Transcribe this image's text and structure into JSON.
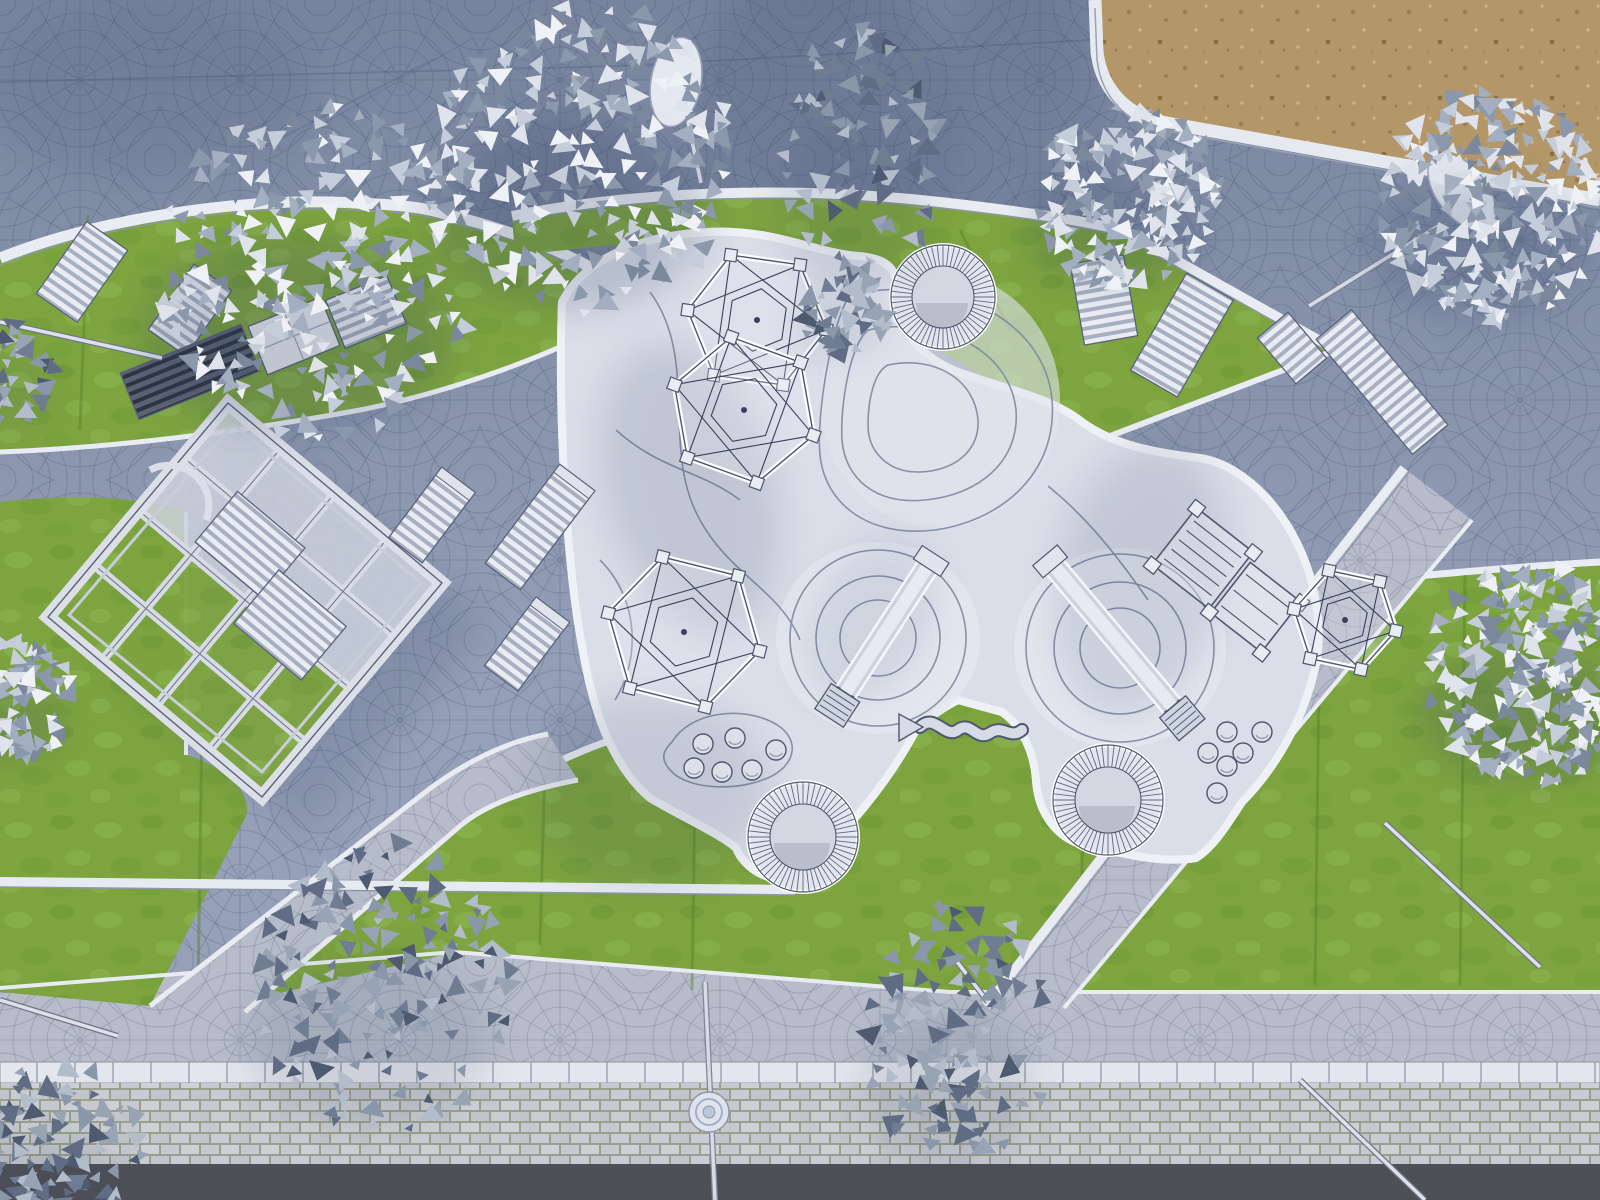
{
  "scene": {
    "kind": "aerial-architectural-render",
    "subject": "top-down clay-style 3D rendering of a public playground plaza with fan-pattern cobblestone paving, organic white play surface, lawns, pergola, play equipment, benches and desaturated trees",
    "camera": "orthographic top-down (drone view)",
    "has_text": false
  },
  "palette": {
    "plaza": "#96a0b8",
    "plazaLine": "#43536f",
    "pathLight": "#b6bcc9",
    "pathLine": "#6b7893",
    "grass": "#7da43f",
    "grassLight": "#8eb853",
    "grassDark": "#6c9434",
    "mow": "#55812d",
    "playSurface": "#d9dee8",
    "playMound": "#e4e8f0",
    "contour": "#7e8aa0",
    "curb": "#e9edf3",
    "edgeDark": "#4e586e",
    "sand": "#b49768",
    "sandDot": "#9a7c4e",
    "sandDotLight": "#cdb488",
    "wallStone": "#c6cad0",
    "wallJoint": "#9aa08b",
    "coping": "#e3e7ed",
    "asphalt": "#4f5056",
    "equipment": "#ccd3df",
    "equipmentLight": "#e8ecf2",
    "shadow": "#2f3d60",
    "treeW1": "#eef1f5",
    "treeW2": "#dfe4ec",
    "treeW3": "#c4cdd9",
    "treeW4": "#a3afc0",
    "treeW5": "#8b98ac",
    "treeG1": "#b3bcca",
    "treeG2": "#98a3b4",
    "treeG3": "#8a96a9",
    "treeG4": "#6f7c92",
    "treeG5": "#5f6c83"
  },
  "objects": {
    "trees": [
      {
        "id": "tree-top-left",
        "type": "white",
        "cx": 318,
        "cy": 272,
        "r": 165
      },
      {
        "id": "tree-top-center-left",
        "type": "white",
        "cx": 585,
        "cy": 158,
        "r": 148,
        "ryf": 1.05
      },
      {
        "id": "tree-top-mid-tall",
        "type": "gray",
        "cx": 860,
        "cy": 150,
        "r": 78,
        "ryf": 1.8
      },
      {
        "id": "leaf-scatter-mid",
        "type": "gray",
        "cx": 846,
        "cy": 308,
        "r": 46
      },
      {
        "id": "tree-top-right-inner",
        "type": "white",
        "cx": 1126,
        "cy": 196,
        "r": 92
      },
      {
        "id": "tree-top-right",
        "type": "white",
        "cx": 1494,
        "cy": 206,
        "r": 115
      },
      {
        "id": "tree-right-edge",
        "type": "white",
        "cx": 1538,
        "cy": 672,
        "r": 112
      },
      {
        "id": "tree-left-edge",
        "type": "white",
        "cx": 14,
        "cy": 700,
        "r": 60
      },
      {
        "id": "tree-left-small",
        "type": "gray",
        "cx": 8,
        "cy": 372,
        "r": 52
      },
      {
        "id": "tree-bottom-left-large",
        "type": "gray",
        "cx": 382,
        "cy": 985,
        "r": 128,
        "ryf": 1.15
      },
      {
        "id": "tree-bottom-center",
        "type": "gray",
        "cx": 958,
        "cy": 1035,
        "r": 92,
        "ryf": 1.5
      },
      {
        "id": "tree-bottom-left-corner",
        "type": "gray",
        "cx": 55,
        "cy": 1150,
        "r": 88
      }
    ],
    "benches": [
      {
        "id": "bench-nw-1",
        "x": 82,
        "y": 272,
        "w": 50,
        "h": 88,
        "rot": 35,
        "style": "light"
      },
      {
        "id": "bench-nw-2",
        "x": 190,
        "y": 310,
        "w": 46,
        "h": 80,
        "rot": 35,
        "style": "light"
      },
      {
        "id": "bench-nw-dark",
        "x": 190,
        "y": 372,
        "w": 130,
        "h": 50,
        "rot": -22,
        "style": "dark"
      },
      {
        "id": "storage-box",
        "x": 294,
        "y": 336,
        "w": 78,
        "h": 52,
        "rot": -22,
        "style": "box"
      },
      {
        "id": "bench-nw-3",
        "x": 366,
        "y": 312,
        "w": 66,
        "h": 52,
        "rot": -22,
        "style": "light"
      },
      {
        "id": "bench-ne-1",
        "x": 1104,
        "y": 300,
        "w": 54,
        "h": 82,
        "rot": -10,
        "style": "light"
      },
      {
        "id": "bench-ne-2",
        "x": 1182,
        "y": 335,
        "w": 54,
        "h": 112,
        "rot": 30,
        "style": "light"
      },
      {
        "id": "bench-east-long",
        "x": 1382,
        "y": 382,
        "w": 46,
        "h": 150,
        "rot": -40,
        "style": "light"
      },
      {
        "id": "bench-east-short",
        "x": 1292,
        "y": 348,
        "w": 40,
        "h": 60,
        "rot": -40,
        "style": "light"
      },
      {
        "id": "pergola-bench-1",
        "x": 250,
        "y": 545,
        "w": 88,
        "h": 66,
        "rot": 40,
        "style": "light"
      },
      {
        "id": "pergola-bench-2",
        "x": 290,
        "y": 625,
        "w": 88,
        "h": 70,
        "rot": 40,
        "style": "light"
      }
    ],
    "loungers": [
      {
        "id": "lounger-1",
        "x": 432,
        "y": 515,
        "w": 42,
        "h": 88,
        "rot": 37
      },
      {
        "id": "lounger-2",
        "x": 540,
        "y": 527,
        "w": 44,
        "h": 124,
        "rot": 37
      },
      {
        "id": "lounger-3",
        "x": 527,
        "y": 644,
        "w": 42,
        "h": 86,
        "rot": 37
      }
    ],
    "climbing_domes": [
      {
        "id": "dome-top-a",
        "cx": 757,
        "cy": 320,
        "r": 70,
        "rot": 8
      },
      {
        "id": "dome-top-b",
        "cx": 744,
        "cy": 410,
        "r": 74,
        "rot": 20
      },
      {
        "id": "dome-left",
        "cx": 684,
        "cy": 632,
        "r": 78,
        "rot": 14
      },
      {
        "id": "dome-right",
        "cx": 1345,
        "cy": 620,
        "r": 52,
        "rot": 12
      }
    ],
    "sand_rings": [
      {
        "id": "ring-top",
        "cx": 943,
        "cy": 297,
        "ro": 52,
        "ri": 31
      },
      {
        "id": "ring-bottom-left",
        "cx": 803,
        "cy": 837,
        "ro": 55,
        "ri": 33
      },
      {
        "id": "ring-bottom-right",
        "cx": 1108,
        "cy": 800,
        "ro": 55,
        "ri": 33
      }
    ],
    "stepping_stones": {
      "cluster_a": [
        [
          703,
          744
        ],
        [
          735,
          738
        ],
        [
          694,
          768
        ],
        [
          722,
          772
        ],
        [
          752,
          770
        ],
        [
          776,
          750
        ]
      ],
      "cluster_b": [
        [
          1227,
          732
        ],
        [
          1262,
          732
        ],
        [
          1208,
          753
        ],
        [
          1243,
          753
        ],
        [
          1227,
          766
        ],
        [
          1217,
          793
        ]
      ]
    },
    "slides": [
      {
        "id": "slide-center",
        "x1": 928,
        "y1": 566,
        "x2": 846,
        "y2": 692
      },
      {
        "id": "slide-right",
        "x1": 1054,
        "y1": 566,
        "x2": 1172,
        "y2": 706
      }
    ],
    "lamps": [
      {
        "id": "lamp-top-center",
        "type": "oval",
        "cx": 676,
        "cy": 82,
        "rot": 10,
        "pole": [
          688,
          122,
          701,
          183
        ]
      },
      {
        "id": "lamp-top-right",
        "type": "oval",
        "cx": 1462,
        "cy": 192,
        "rot": -38,
        "pole": [
          1438,
          226,
          1309,
          306
        ]
      },
      {
        "id": "lamp-bottom",
        "type": "round",
        "cx": 709,
        "cy": 1112,
        "pole": [
          705,
          982,
          715,
          1200
        ]
      }
    ],
    "poles_rails": [
      [
        1385,
        823,
        1540,
        967
      ],
      [
        1300,
        1080,
        1425,
        1200
      ],
      [
        0,
        322,
        162,
        358
      ],
      [
        0,
        1000,
        118,
        1036
      ],
      [
        948,
        950,
        988,
        1002
      ]
    ],
    "balance_beam": {
      "id": "wavy-balance-beam",
      "from": [
        920,
        727
      ],
      "to": [
        1022,
        730
      ]
    },
    "pergola": {
      "id": "pergola",
      "corners": [
        [
          228,
          403
        ],
        [
          442,
          583
        ],
        [
          262,
          797
        ],
        [
          48,
          617
        ]
      ]
    }
  }
}
